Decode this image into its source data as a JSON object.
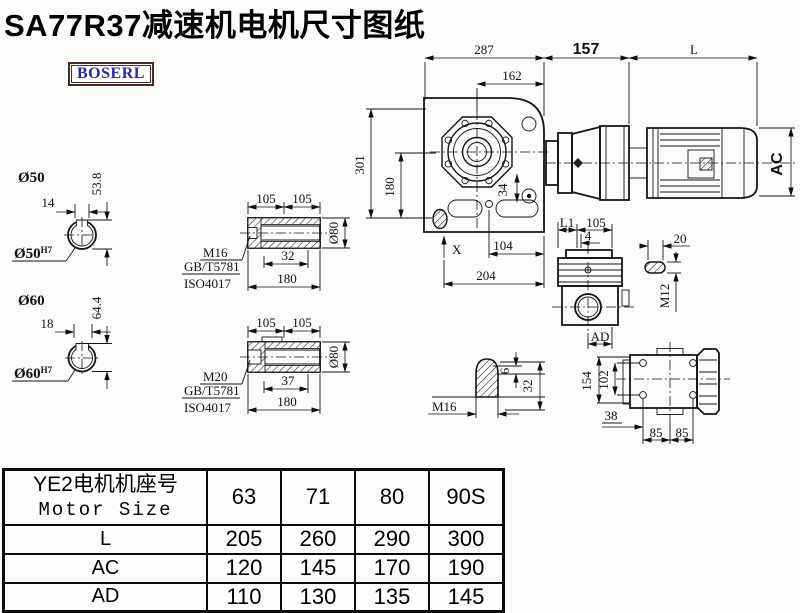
{
  "title": "SA77R37减速机电机尺寸图纸",
  "logo_text": "BOSERL",
  "assembly": {
    "top_dims": {
      "overall_width": "287",
      "flange_offset": "162",
      "adapter_len": "157",
      "motor_len": "L"
    },
    "left_dims": {
      "overall_height": "301",
      "center_to_base": "180"
    },
    "front_dims": {
      "bolt_offset": "34",
      "x_ref": "X",
      "base_a": "104",
      "base_b": "204"
    },
    "motor_dims": {
      "motor_height": "AC"
    }
  },
  "bore50": {
    "label": "Ø50",
    "key_width": "14",
    "key_depth": "53.8",
    "dia_text": "Ø50",
    "tol": "H7"
  },
  "bore60": {
    "label": "Ø60",
    "key_width": "18",
    "key_depth": "64.4",
    "dia_text": "Ø60",
    "tol": "H7"
  },
  "hollow_shaft_a": {
    "len_a": "105",
    "len_b": "105",
    "thread_depth": "32",
    "length": "180",
    "dia": "Ø80",
    "thread": "M16",
    "std1": "GB/T5781",
    "std2": "ISO4017"
  },
  "hollow_shaft_b": {
    "len_a": "105",
    "len_b": "105",
    "thread_depth": "37",
    "length": "180",
    "dia": "Ø80",
    "thread": "M20",
    "std1": "GB/T5781",
    "std2": "ISO4017"
  },
  "side_view": {
    "l1": "L1",
    "len": "105",
    "offset": "4",
    "ad": "AD"
  },
  "key_detail": {
    "len": "20",
    "thread": "M12"
  },
  "shaft_end": {
    "depth": "6",
    "len": "32",
    "thread": "M16"
  },
  "top_view": {
    "height": "154",
    "hole_span": "102",
    "offset": "38",
    "pitch_a": "85",
    "pitch_b": "85"
  },
  "table": {
    "header_cn": "YE2电机机座号",
    "header_en": "Motor Size",
    "columns": [
      "63",
      "71",
      "80",
      "90S"
    ],
    "rows": [
      {
        "label": "L",
        "values": [
          "205",
          "260",
          "290",
          "300"
        ]
      },
      {
        "label": "AC",
        "values": [
          "120",
          "145",
          "170",
          "190"
        ]
      },
      {
        "label": "AD",
        "values": [
          "110",
          "130",
          "135",
          "145"
        ]
      }
    ]
  }
}
